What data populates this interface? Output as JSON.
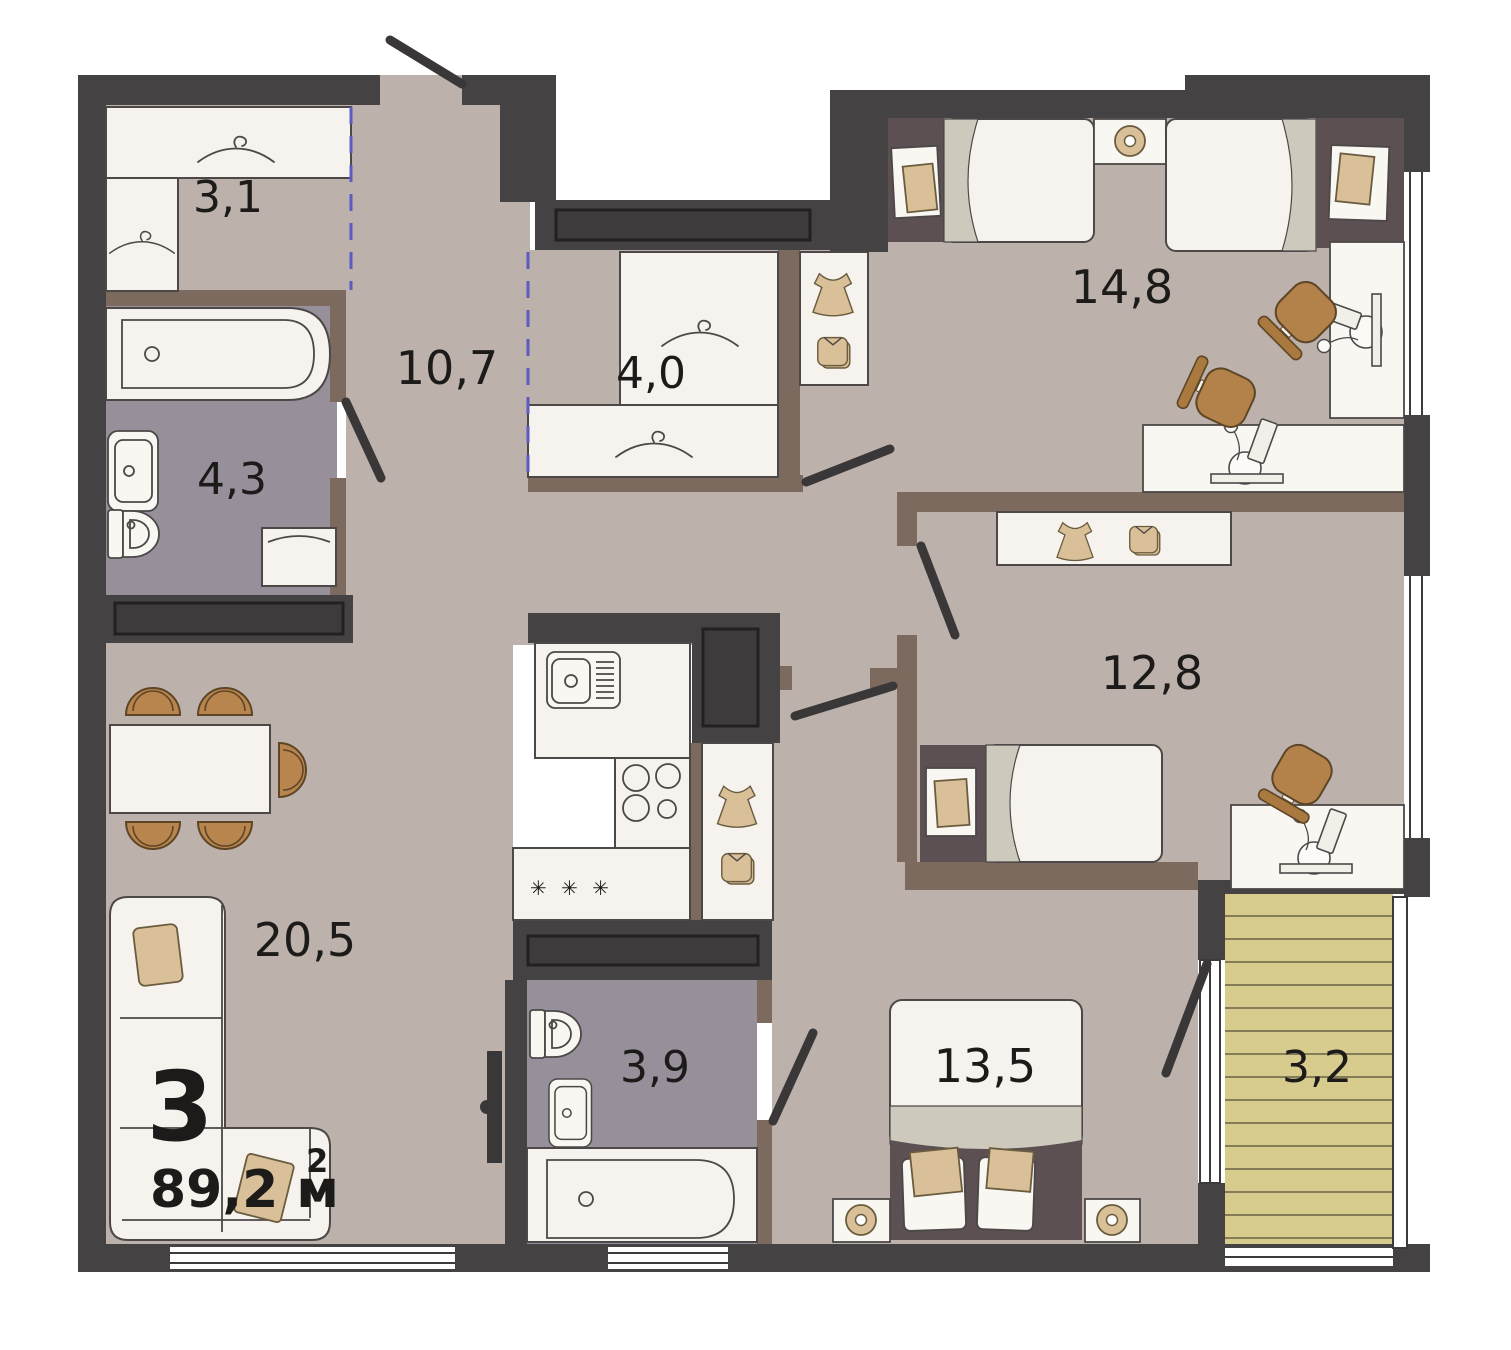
{
  "plan": {
    "summary": {
      "rooms_count": "3",
      "area": "89,2 м",
      "area_sup": "2"
    },
    "rooms": [
      {
        "name": "wardrobe",
        "area": "3,1"
      },
      {
        "name": "hallway",
        "area": "10,7"
      },
      {
        "name": "closet",
        "area": "4,0"
      },
      {
        "name": "bedroom-1",
        "area": "14,8"
      },
      {
        "name": "bathroom-1",
        "area": "4,3"
      },
      {
        "name": "bedroom-2",
        "area": "12,8"
      },
      {
        "name": "living-room",
        "area": "20,5"
      },
      {
        "name": "bathroom-2",
        "area": "3,9"
      },
      {
        "name": "bedroom-3",
        "area": "13,5"
      },
      {
        "name": "balcony",
        "area": "3,2"
      }
    ],
    "kitchen": {
      "dishwasher_symbol": "✳ ✳ ✳"
    },
    "colors": {
      "wall_dark": "#454243",
      "wall_brown": "#7d6a5f",
      "floor": "#bdb2ab",
      "bathroom_floor": "#97909b",
      "furniture_white": "#f6f3ee",
      "furniture_tan": "#d9c098",
      "chair_brown": "#b3824a",
      "balcony_deck": "#d7cb8e",
      "virtual_divider": "#5b5bc0",
      "label_text": "#1c1b1a"
    }
  }
}
